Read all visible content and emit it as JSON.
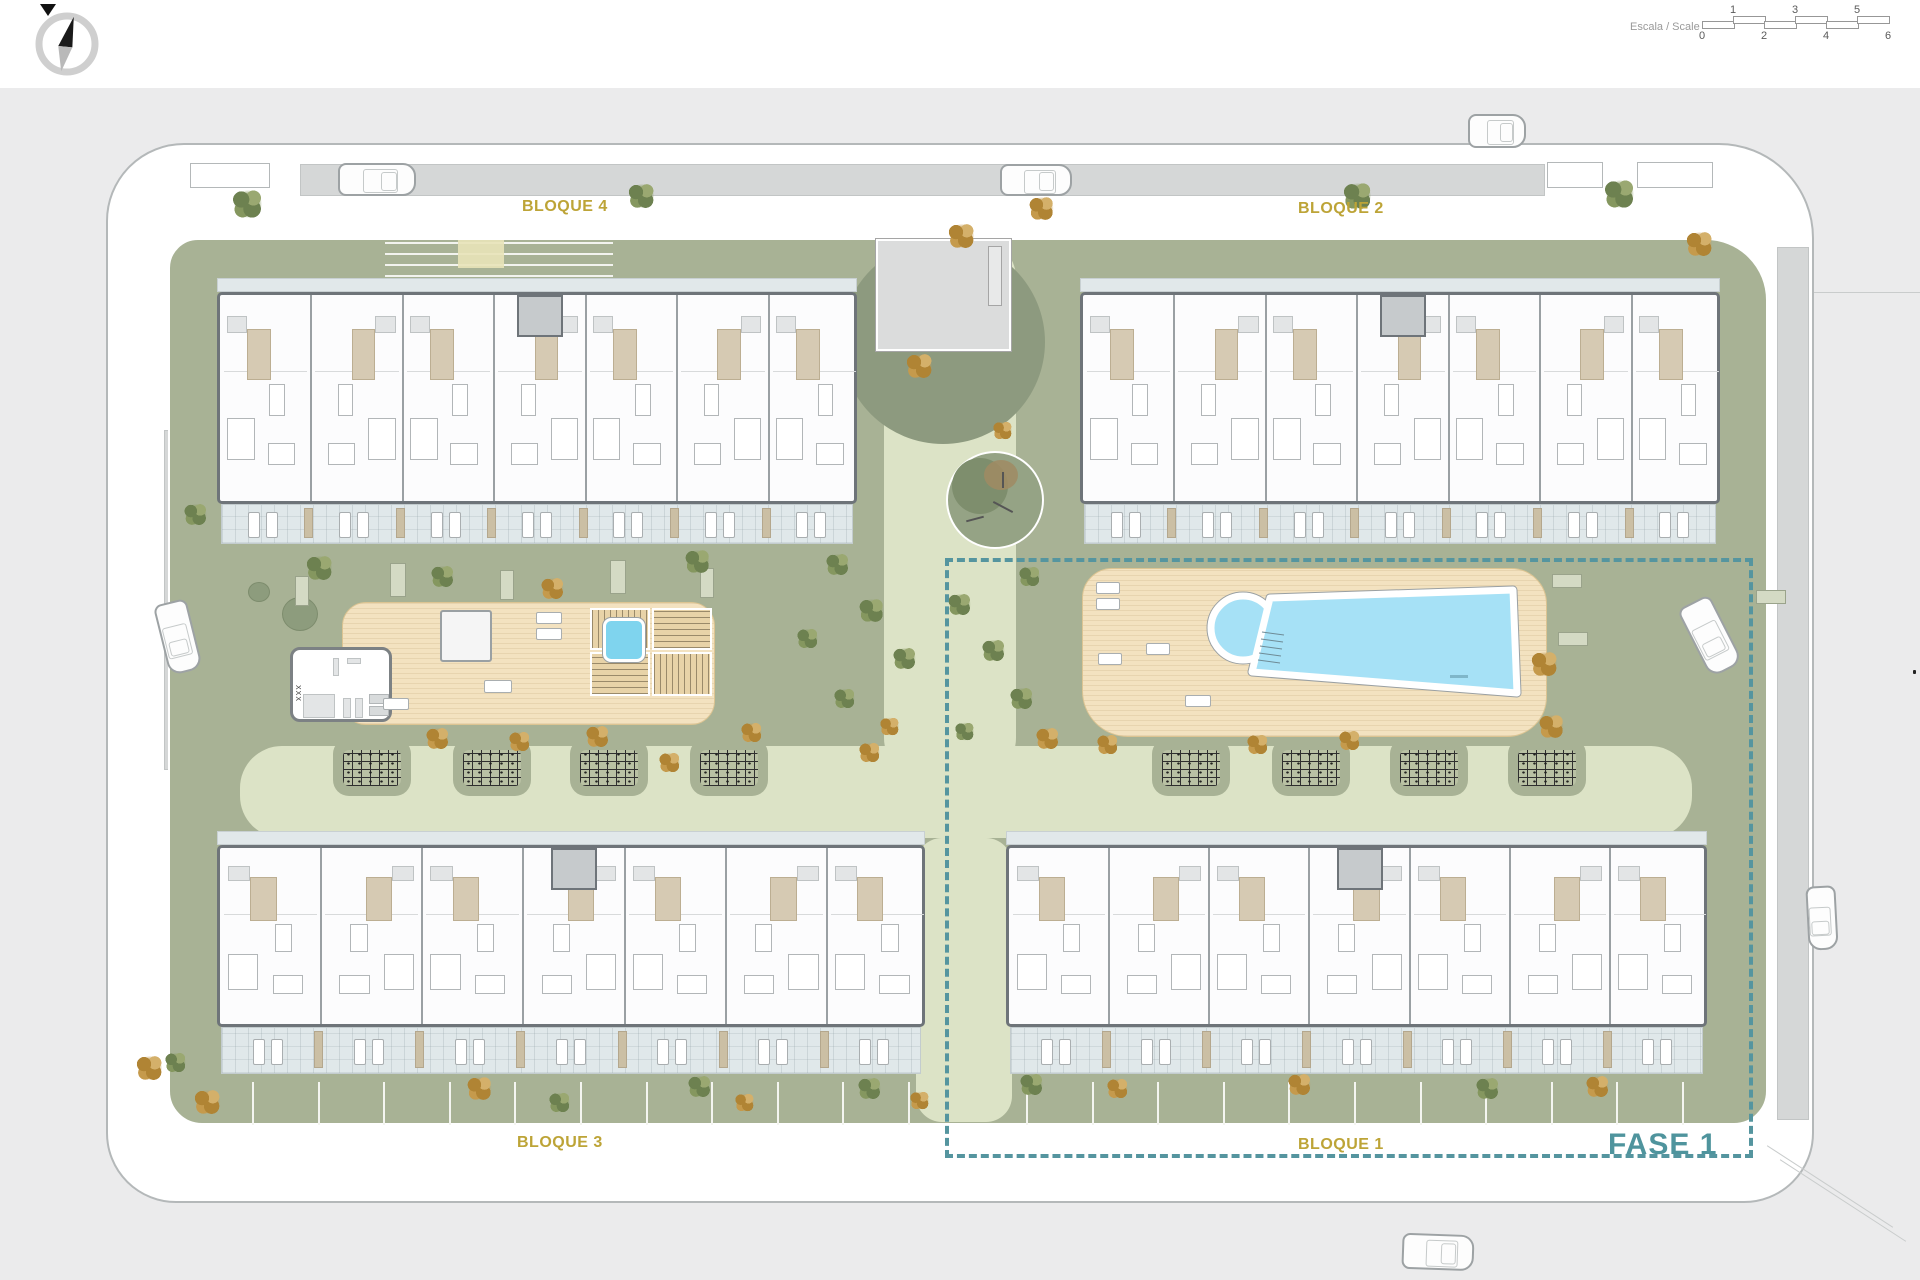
{
  "header": {
    "scale_label": "Escala / Scale",
    "scale_top_numbers": [
      "1",
      "3",
      "5"
    ],
    "scale_bottom_numbers": [
      "0",
      "2",
      "4",
      "6"
    ],
    "compass_icon": "north-compass-icon"
  },
  "plan": {
    "phase_label": "FASE 1",
    "blocks": [
      {
        "id": "bloque-4",
        "label": "BLOQUE 4"
      },
      {
        "id": "bloque-2",
        "label": "BLOQUE 2"
      },
      {
        "id": "bloque-3",
        "label": "BLOQUE 3"
      },
      {
        "id": "bloque-1",
        "label": "BLOQUE 1"
      }
    ],
    "gym_label": "XXX",
    "colors": {
      "label_yellow": "#bda437",
      "phase_teal": "#55959f",
      "site_green": "#a8b295",
      "path_green": "#dce3c6",
      "deck_wood": "#f3e2c0",
      "pool_blue": "#a6e1f6",
      "wall_gray": "#6e7479",
      "terrace_blue": "#e0e8ea",
      "sidewalk_gray": "#d5d7d7",
      "outer_gray": "#ebebec"
    },
    "buildings": [
      {
        "name": "bloque-4",
        "x": 217,
        "y": 190,
        "w": 640,
        "pave": 14,
        "body": 212,
        "terrace": 40,
        "units": 7
      },
      {
        "name": "bloque-2",
        "x": 1080,
        "y": 190,
        "w": 640,
        "pave": 14,
        "body": 212,
        "terrace": 40,
        "units": 7
      },
      {
        "name": "bloque-3",
        "x": 217,
        "y": 743,
        "w": 708,
        "pave": 14,
        "body": 182,
        "terrace": 47,
        "units": 7
      },
      {
        "name": "bloque-1",
        "x": 1006,
        "y": 743,
        "w": 701,
        "pave": 14,
        "body": 182,
        "terrace": 47,
        "units": 7
      }
    ],
    "trees": [
      [
        248,
        118,
        34,
        "g"
      ],
      [
        642,
        110,
        30,
        "g"
      ],
      [
        962,
        150,
        30,
        "o"
      ],
      [
        1042,
        122,
        28,
        "o"
      ],
      [
        1358,
        110,
        32,
        "g"
      ],
      [
        1620,
        108,
        34,
        "g"
      ],
      [
        1700,
        158,
        30,
        "o"
      ],
      [
        196,
        428,
        26,
        "g"
      ],
      [
        320,
        482,
        30,
        "g"
      ],
      [
        443,
        490,
        26,
        "g"
      ],
      [
        553,
        502,
        26,
        "o"
      ],
      [
        698,
        475,
        28,
        "g"
      ],
      [
        838,
        478,
        26,
        "g"
      ],
      [
        872,
        524,
        28,
        "g"
      ],
      [
        905,
        572,
        26,
        "g"
      ],
      [
        845,
        612,
        24,
        "g"
      ],
      [
        960,
        518,
        26,
        "g"
      ],
      [
        994,
        564,
        26,
        "g"
      ],
      [
        1022,
        612,
        26,
        "g"
      ],
      [
        965,
        645,
        22,
        "g"
      ],
      [
        808,
        552,
        24,
        "g"
      ],
      [
        890,
        640,
        22,
        "o"
      ],
      [
        1030,
        490,
        24,
        "g"
      ],
      [
        920,
        280,
        30,
        "o"
      ],
      [
        1003,
        344,
        22,
        "o"
      ],
      [
        438,
        652,
        26,
        "o"
      ],
      [
        520,
        655,
        24,
        "o"
      ],
      [
        598,
        650,
        26,
        "o"
      ],
      [
        670,
        676,
        24,
        "o"
      ],
      [
        752,
        646,
        24,
        "o"
      ],
      [
        870,
        666,
        24,
        "o"
      ],
      [
        1048,
        652,
        26,
        "o"
      ],
      [
        1108,
        658,
        24,
        "o"
      ],
      [
        1258,
        658,
        24,
        "o"
      ],
      [
        1350,
        654,
        24,
        "o"
      ],
      [
        1545,
        578,
        30,
        "o"
      ],
      [
        1552,
        640,
        28,
        "o"
      ],
      [
        150,
        982,
        30,
        "o"
      ],
      [
        208,
        1016,
        30,
        "o"
      ],
      [
        176,
        976,
        24,
        "g"
      ],
      [
        480,
        1002,
        28,
        "o"
      ],
      [
        560,
        1016,
        24,
        "g"
      ],
      [
        700,
        1000,
        26,
        "g"
      ],
      [
        745,
        1016,
        22,
        "o"
      ],
      [
        870,
        1002,
        26,
        "g"
      ],
      [
        920,
        1014,
        22,
        "o"
      ],
      [
        1032,
        998,
        26,
        "g"
      ],
      [
        1118,
        1002,
        24,
        "o"
      ],
      [
        1300,
        998,
        26,
        "o"
      ],
      [
        1488,
        1002,
        26,
        "g"
      ],
      [
        1598,
        1000,
        26,
        "o"
      ]
    ],
    "cars": [
      [
        338,
        75,
        78,
        33,
        0
      ],
      [
        1000,
        76,
        72,
        32,
        0
      ],
      [
        1468,
        26,
        58,
        34,
        0
      ],
      [
        142,
        532,
        72,
        34,
        76
      ],
      [
        1672,
        530,
        76,
        36,
        63
      ],
      [
        1402,
        1146,
        72,
        36,
        2
      ],
      [
        1790,
        815,
        64,
        30,
        87
      ]
    ],
    "pergolas": [
      [
        343,
        662
      ],
      [
        463,
        662
      ],
      [
        580,
        662
      ],
      [
        700,
        662
      ],
      [
        1162,
        662
      ],
      [
        1282,
        662
      ],
      [
        1400,
        662
      ],
      [
        1518,
        662
      ]
    ],
    "aprons": [
      [
        190,
        75,
        80,
        25
      ],
      [
        1547,
        74,
        56,
        26
      ],
      [
        1637,
        74,
        76,
        26
      ]
    ],
    "benches": [
      [
        295,
        488,
        14,
        30
      ],
      [
        390,
        475,
        16,
        34
      ],
      [
        500,
        482,
        14,
        30
      ],
      [
        610,
        472,
        16,
        34
      ],
      [
        700,
        480,
        14,
        30
      ],
      [
        1552,
        486,
        30,
        14
      ],
      [
        1558,
        544,
        30,
        14
      ],
      [
        1756,
        502,
        30,
        14
      ]
    ],
    "deck_loungers": [
      [
        536,
        524,
        26,
        12
      ],
      [
        536,
        540,
        26,
        12
      ],
      [
        484,
        592,
        28,
        13
      ],
      [
        383,
        610,
        26,
        12
      ],
      [
        1096,
        494,
        24,
        12
      ],
      [
        1096,
        510,
        24,
        12
      ],
      [
        1146,
        555,
        24,
        12
      ],
      [
        1098,
        565,
        24,
        12
      ],
      [
        1185,
        607,
        26,
        12
      ]
    ],
    "parking_bottom": [
      {
        "x1": 252,
        "count": 11,
        "step": 65.6,
        "y": 994,
        "h": 43
      },
      {
        "x1": 1026,
        "count": 11,
        "step": 65.6,
        "y": 994,
        "h": 43
      }
    ],
    "parking_top_rows": {
      "x": 385,
      "y": 154,
      "w": 228,
      "rows": 6,
      "gap": 11
    }
  }
}
